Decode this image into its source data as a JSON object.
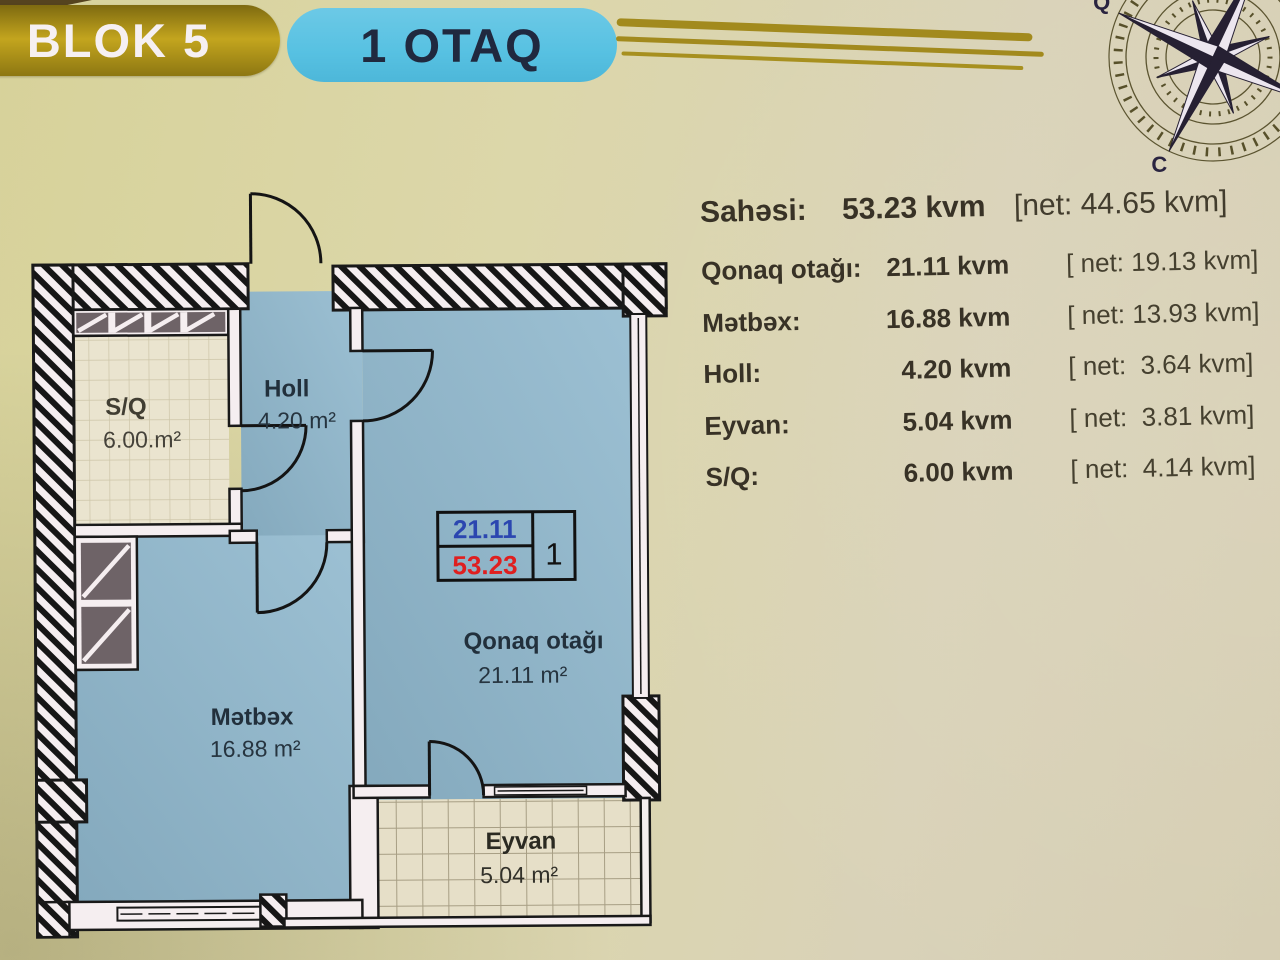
{
  "header": {
    "block_badge": "BLOK 5",
    "type_badge": "1 OTAQ"
  },
  "compass": {
    "west_label": "Q",
    "south_label": "C"
  },
  "summary": {
    "label": "Sahəsi:",
    "value": "53.23 kvm",
    "net": "[net: 44.65 kvm]"
  },
  "area_table": {
    "rows": [
      {
        "label": "Qonaq otağı:",
        "value": "21.11 kvm",
        "net": "[ net: 19.13 kvm]"
      },
      {
        "label": "Mətbəx:",
        "value": "16.88 kvm",
        "net": "[ net: 13.93 kvm]"
      },
      {
        "label": "Holl:",
        "value": "4.20 kvm",
        "net": "[ net:  3.64 kvm]"
      },
      {
        "label": "Eyvan:",
        "value": "5.04 kvm",
        "net": "[ net:  3.81 kvm]"
      },
      {
        "label": "S/Q:",
        "value": "6.00 kvm",
        "net": "[ net:  4.14 kvm]"
      }
    ]
  },
  "plan": {
    "sq": {
      "name": "S/Q",
      "area": "6.00.m²"
    },
    "holl": {
      "name": "Holl",
      "area": "4.20 m²"
    },
    "qonaq": {
      "name": "Qonaq otağı",
      "area": "21.11 m²"
    },
    "metbex": {
      "name": "Mətbəx",
      "area": "16.88 m²"
    },
    "eyvan": {
      "name": "Eyvan",
      "area": "5.04 m²"
    },
    "unit_box": {
      "net_area": "21.11",
      "total_area": "53.23",
      "unit_number": "1"
    }
  },
  "colors": {
    "background": "#d9d3ab",
    "accent_gold": "#a28a1d",
    "badge_blue": "#57c1e2",
    "badge_text_dark": "#20293f",
    "room_fill_blue": "#90b5c9",
    "tile_beige": "#e9e3ce",
    "wall_fill": "#f5eef0",
    "line_black": "#191919",
    "unit_net_color": "#2b46b0",
    "unit_total_color": "#df1f1f"
  }
}
